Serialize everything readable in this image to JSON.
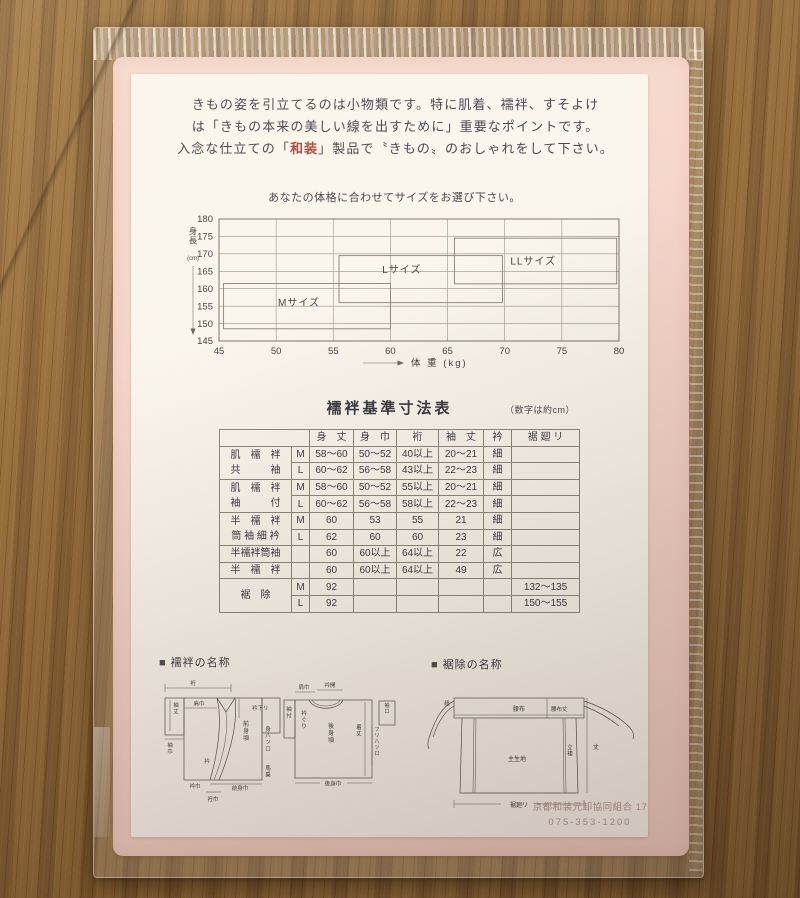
{
  "intro": {
    "line1": "きもの姿を引立てるのは小物類です。特に肌着、襦袢、すそよけ",
    "line2": "は「きもの本来の美しい線を出すために」重要なポイントです。",
    "line3_pre": "入念な仕立ての「",
    "line3_red": "和装",
    "line3_post": "」製品で〝きもの〟のおしゃれをして下さい。"
  },
  "chart_data": {
    "type": "range-boxes",
    "title": "あなたの体格に合わせてサイズをお選び下さい。",
    "xlabel": "体 重 (kg)",
    "ylabel": "身長",
    "ylabel_unit": "(cm)",
    "xlim": [
      45,
      80
    ],
    "ylim": [
      145,
      180
    ],
    "xticks": [
      45,
      50,
      55,
      60,
      65,
      70,
      75,
      80
    ],
    "yticks": [
      145,
      150,
      155,
      160,
      165,
      170,
      175,
      180
    ],
    "grid": true,
    "boxes": [
      {
        "label": "Mサイズ",
        "x_range": [
          45.4,
          60.0
        ],
        "y_range": [
          148.5,
          161.5
        ],
        "label_at": [
          52.0,
          156.0
        ]
      },
      {
        "label": "Lサイズ",
        "x_range": [
          55.5,
          69.8
        ],
        "y_range": [
          156.0,
          169.5
        ],
        "label_at": [
          61.0,
          165.5
        ]
      },
      {
        "label": "LLサイズ",
        "x_range": [
          65.6,
          79.8
        ],
        "y_range": [
          161.4,
          174.5
        ],
        "label_at": [
          72.5,
          168.0
        ]
      }
    ]
  },
  "size_table": {
    "title": "襦袢基準寸法表",
    "note": "（数字は約cm）",
    "headers": [
      "身　丈",
      "身　巾",
      "裄",
      "袖　丈",
      "衿",
      "裾 廻 リ"
    ],
    "groups": [
      {
        "name_lines": [
          "肌　襦　袢",
          "共　　　袖"
        ],
        "rows": [
          [
            "M",
            "58〜60",
            "50〜52",
            "40以上",
            "20〜21",
            "細",
            ""
          ],
          [
            "L",
            "60〜62",
            "56〜58",
            "43以上",
            "22〜23",
            "細",
            ""
          ]
        ]
      },
      {
        "name_lines": [
          "肌　襦　袢",
          "袖　　　付"
        ],
        "rows": [
          [
            "M",
            "58〜60",
            "50〜52",
            "55以上",
            "20〜21",
            "細",
            ""
          ],
          [
            "L",
            "60〜62",
            "56〜58",
            "58以上",
            "22〜23",
            "細",
            ""
          ]
        ]
      },
      {
        "name_lines": [
          "半　襦　袢",
          "筒 袖 細 衿"
        ],
        "rows": [
          [
            "M",
            "60",
            "53",
            "55",
            "21",
            "細",
            ""
          ],
          [
            "L",
            "62",
            "60",
            "60",
            "23",
            "細",
            ""
          ]
        ]
      },
      {
        "name_lines": [
          "半襦袢筒袖"
        ],
        "rows": [
          [
            "",
            "60",
            "60以上",
            "64以上",
            "22",
            "広",
            ""
          ]
        ]
      },
      {
        "name_lines": [
          "半　襦　袢"
        ],
        "rows": [
          [
            "",
            "60",
            "60以上",
            "64以上",
            "49",
            "広",
            ""
          ]
        ]
      },
      {
        "name_lines": [
          "裾　除"
        ],
        "rows": [
          [
            "M",
            "92",
            "",
            "",
            "",
            "",
            "132〜135"
          ],
          [
            "L",
            "92",
            "",
            "",
            "",
            "",
            "150〜155"
          ]
        ]
      }
    ]
  },
  "sections": {
    "juban": {
      "marker": "■",
      "title": "襦袢の名称"
    },
    "susoyoke": {
      "marker": "■",
      "title": "裾除の名称"
    }
  },
  "juban_diagram": {
    "front": {
      "yuki": "裄",
      "sodetake": "袖丈",
      "sodehaba": "袖巾",
      "katahaba": "肩巾",
      "erisagari": "衿下リ",
      "maemigoro": "前身頃",
      "eri": "衿",
      "miyatsuguchi": "身八ツ口",
      "umanori": "馬乗",
      "erihaba": "衿巾",
      "maemihaba": "前身巾",
      "okumihaba": "衽巾"
    },
    "back": {
      "katahaba": "肩巾",
      "eriaki": "衿開",
      "sodetsuke": "袖付",
      "eriguri": "衿ぐり",
      "ushiromigoro": "後身頃",
      "kitake": "着丈",
      "sodeguchi": "袖口",
      "furiyatsuguchi": "フリ八ツ口",
      "ushiromihaba": "後身巾"
    }
  },
  "susoyoke_diagram": {
    "himo": "紐",
    "koshinuno": "腰布",
    "koshinunotake": "腰布丈",
    "omokiji": "主生地",
    "tatetsuma": "立褄",
    "take": "丈",
    "susomawari": "裾廻リ"
  },
  "stamp": {
    "line1": "京都和装元卸協同組合 17",
    "line2": "075-353-1200"
  }
}
